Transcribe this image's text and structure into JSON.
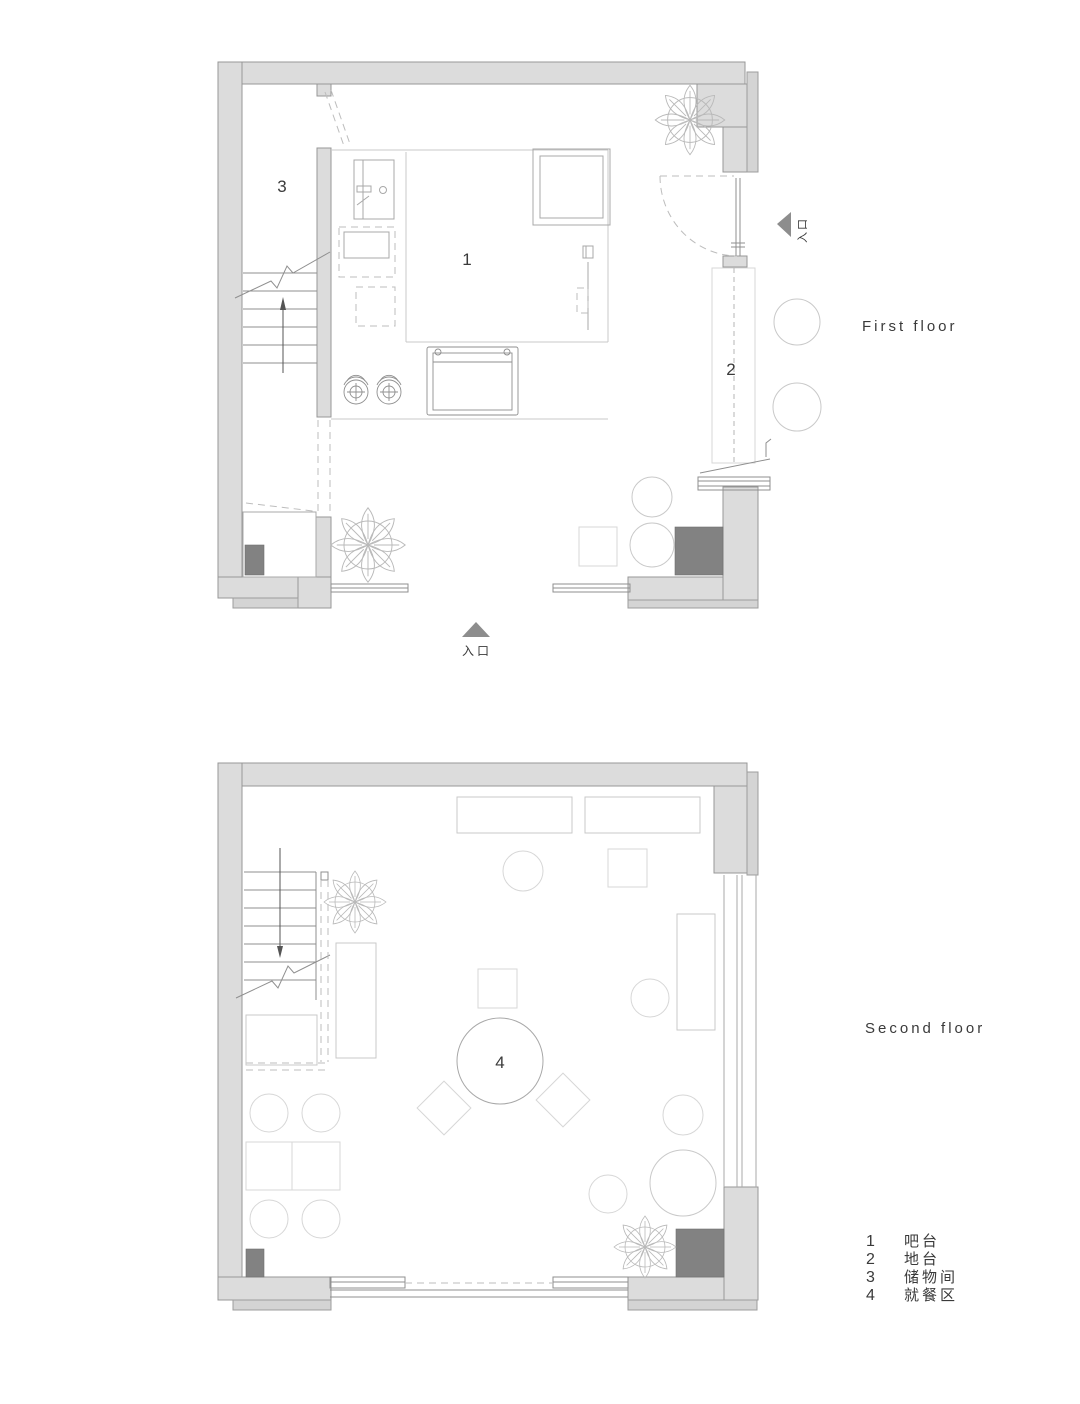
{
  "page": {
    "background": "#ffffff"
  },
  "colors": {
    "wall_fill": "#dcdcdc",
    "wall_stroke": "#979797",
    "column_fill": "#828282",
    "marker_fill": "#8d8d8d",
    "furniture_line": "#c9c9c9",
    "text": "#3a3a3a"
  },
  "first_floor": {
    "caption": "First floor",
    "labels": {
      "bar": "1",
      "platform": "2",
      "storage": "3"
    },
    "entrance_label": "入口",
    "side_door_label": "入口"
  },
  "second_floor": {
    "caption": "Second floor",
    "labels": {
      "dining": "4"
    }
  },
  "legend": {
    "items": [
      {
        "num": "1",
        "label": "吧台"
      },
      {
        "num": "2",
        "label": "地台"
      },
      {
        "num": "3",
        "label": "储物间"
      },
      {
        "num": "4",
        "label": "就餐区"
      }
    ]
  }
}
